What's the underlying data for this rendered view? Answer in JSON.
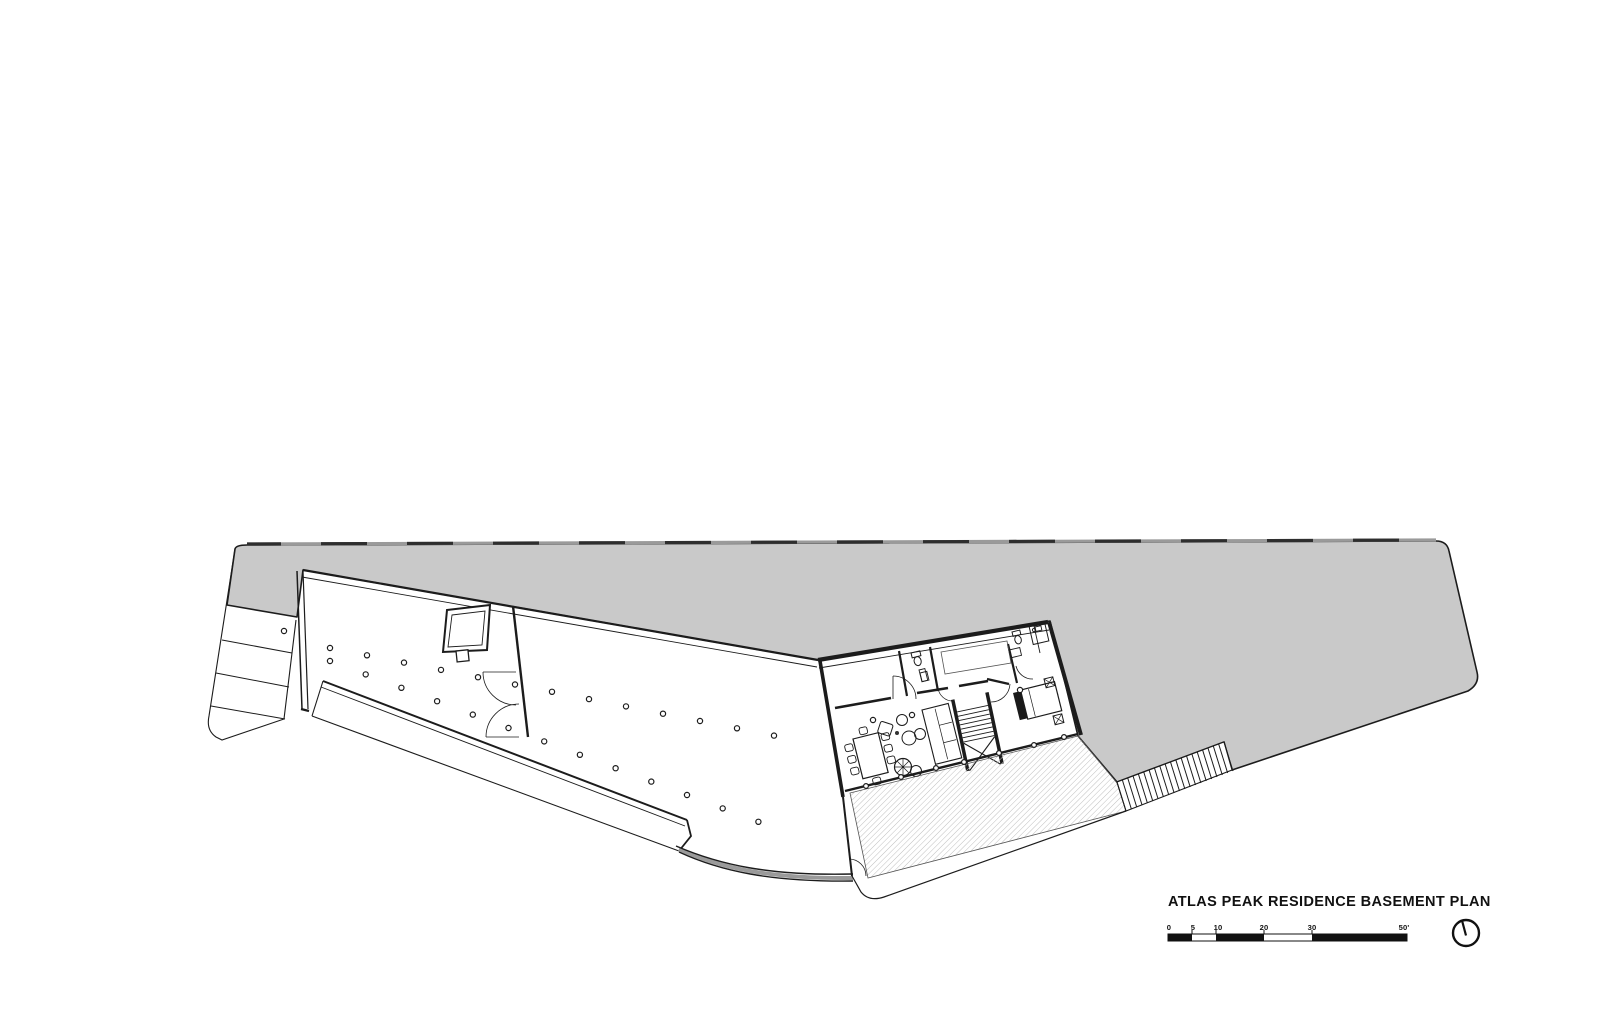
{
  "title_block": {
    "title": "ATLAS PEAK RESIDENCE BASEMENT PLAN"
  },
  "scale_bar": {
    "labels": [
      "0",
      "5",
      "10",
      "20",
      "30",
      "50'"
    ]
  },
  "icons": {
    "north_arrow": "north-arrow-icon"
  },
  "colors": {
    "site_fill": "#C9C9C9",
    "line": "#1C1C1C",
    "hatch": "#BFBFBF",
    "background": "#FFFFFF"
  },
  "plan": {
    "columns": {
      "rows": [
        {
          "x0": 330,
          "y0": 648,
          "dx": 37.0,
          "dy": 7.3,
          "count": 13
        },
        {
          "x0": 330,
          "y0": 661,
          "dx": 35.7,
          "dy": 13.4,
          "count": 13
        }
      ],
      "extra": [
        [
          284,
          631
        ],
        [
          873,
          720
        ],
        [
          912,
          715
        ],
        [
          1020,
          690
        ]
      ]
    },
    "deck_posts": [
      [
        866,
        786
      ],
      [
        901,
        777
      ],
      [
        936,
        768
      ],
      [
        964,
        762
      ],
      [
        999,
        753
      ],
      [
        1034,
        745
      ],
      [
        1064,
        737
      ]
    ],
    "exterior_stair": {
      "x0": 1117,
      "y0": 782,
      "dx": 5.35,
      "dy": -2.0,
      "count": 21,
      "tx": 9,
      "ty": 29
    }
  }
}
